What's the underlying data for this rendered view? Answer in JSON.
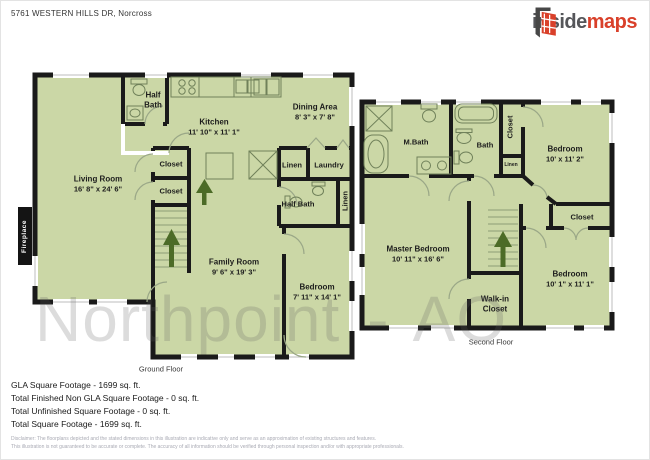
{
  "header": {
    "address": "5761 WESTERN HILLS DR, Norcross",
    "logo": {
      "inside": "inside",
      "maps": "maps"
    }
  },
  "watermark": "Northpoint - AO",
  "floors": {
    "ground": {
      "caption": "Ground Floor",
      "fireplace": "Fireplace",
      "rooms": {
        "living": {
          "name": "Living Room",
          "dims": "16' 8\" x 24' 6\""
        },
        "half_bath_top": {
          "name": "Half Bath"
        },
        "kitchen": {
          "name": "Kitchen",
          "dims": "11' 10\" x 11' 1\""
        },
        "dining": {
          "name": "Dining Area",
          "dims": "8' 3\" x 7' 8\""
        },
        "closet1": {
          "name": "Closet"
        },
        "closet2": {
          "name": "Closet"
        },
        "linen": {
          "name": "Linen"
        },
        "laundry": {
          "name": "Laundry"
        },
        "half_bath_right": {
          "name": "Half Bath"
        },
        "linen_vertical": {
          "name": "Linen"
        },
        "family": {
          "name": "Family Room",
          "dims": "9' 6\" x 19' 3\""
        },
        "bedroom": {
          "name": "Bedroom",
          "dims": "7' 11\" x 14' 1\""
        }
      }
    },
    "second": {
      "caption": "Second Floor",
      "rooms": {
        "mbath": {
          "name": "M.Bath"
        },
        "bath": {
          "name": "Bath"
        },
        "closet_vert": {
          "name": "Closet"
        },
        "linen": {
          "name": "Linen"
        },
        "bedroom1": {
          "name": "Bedroom",
          "dims": "10' x 11' 2\""
        },
        "master": {
          "name": "Master Bedroom",
          "dims": "10' 11\" x 16' 6\""
        },
        "closet_right": {
          "name": "Closet"
        },
        "bedroom2": {
          "name": "Bedroom",
          "dims": "10' 1\" x 11' 1\""
        },
        "walkin": {
          "name": "Walk-in Closet"
        }
      }
    }
  },
  "footer": {
    "lines": [
      "GLA Square Footage - 1699 sq. ft.",
      "Total Finished Non GLA Square Footage - 0 sq. ft.",
      "Total Unfinished Square Footage - 0 sq. ft.",
      "Total Square Footage - 1699 sq. ft."
    ],
    "disclaimer1": "Disclaimer: The floorplans depicted and the stated dimensions in this illustration are indicative only and serve as an approximation of existing structures and features.",
    "disclaimer2": "This illustration is not guaranteed to be accurate or complete. The accuracy of all information should be verified through personal inspection and/or with appropriate professionals."
  },
  "colors": {
    "room_fill": "#cbd7a6",
    "wall": "#1a1a1a",
    "accent_red": "#d9402a",
    "arrow_green": "#4c6b27"
  }
}
